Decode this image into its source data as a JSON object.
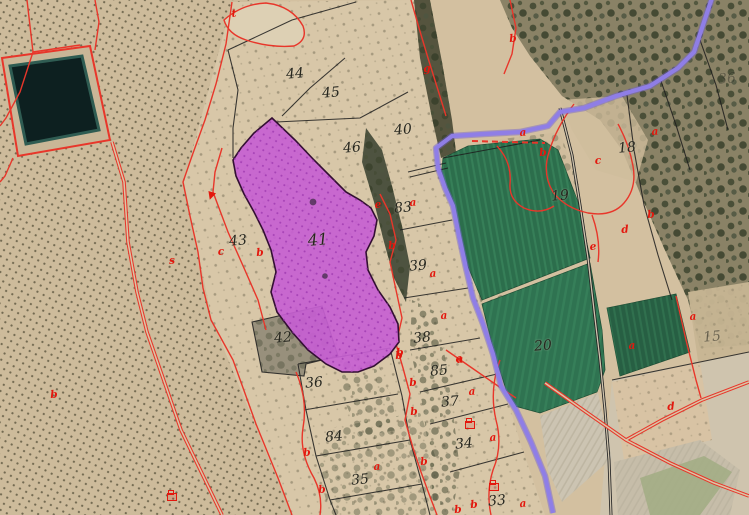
{
  "map": {
    "description": "Cadastral parcel map overlaid on aerial orthophoto; parcel 41 highlighted",
    "colors": {
      "base_tan": "#d3c0a0",
      "light_tan": "#dccdb0",
      "scrub_dark": "#3f462f",
      "water_dark": "#0d2020",
      "water_rim": "#2f5c52",
      "field_green": "#2c6e4c",
      "field_green_dark": "#275f43",
      "plow_gray": "#ccc4b2",
      "cadastral_red": "#e8362a",
      "label_red": "#e3170d",
      "label_black": "#26261e",
      "path_purple": "#8f7ee6",
      "parcel_magenta": "#c760d2",
      "parcel_magenta_dot": "#9c36ae",
      "parcel_border": "#330f33",
      "boundary_black": "#1d1d1d"
    },
    "highlighted_parcel": {
      "number": "41",
      "fill": "#c760d2"
    },
    "parcel_labels": [
      {
        "text": "44",
        "x": 295,
        "y": 74
      },
      {
        "text": "45",
        "x": 331,
        "y": 93
      },
      {
        "text": "46",
        "x": 352,
        "y": 148
      },
      {
        "text": "40",
        "x": 403,
        "y": 130
      },
      {
        "text": "83",
        "x": 403,
        "y": 208
      },
      {
        "text": "41",
        "x": 318,
        "y": 240,
        "size": 16
      },
      {
        "text": "43",
        "x": 238,
        "y": 241
      },
      {
        "text": "39",
        "x": 418,
        "y": 266
      },
      {
        "text": "42",
        "x": 283,
        "y": 338
      },
      {
        "text": "38",
        "x": 422,
        "y": 338
      },
      {
        "text": "36",
        "x": 314,
        "y": 383
      },
      {
        "text": "85",
        "x": 439,
        "y": 371
      },
      {
        "text": "37",
        "x": 450,
        "y": 402
      },
      {
        "text": "84",
        "x": 334,
        "y": 437
      },
      {
        "text": "34",
        "x": 464,
        "y": 444
      },
      {
        "text": "35",
        "x": 360,
        "y": 480
      },
      {
        "text": "33",
        "x": 497,
        "y": 501
      },
      {
        "text": "19",
        "x": 560,
        "y": 196
      },
      {
        "text": "18",
        "x": 627,
        "y": 148
      },
      {
        "text": "20",
        "x": 543,
        "y": 346
      },
      {
        "text": "15",
        "x": 712,
        "y": 337,
        "opacity": 0.55
      },
      {
        "text": "36",
        "x": 727,
        "y": 79,
        "opacity": 0.4
      }
    ],
    "subparcel_labels": [
      {
        "text": "t",
        "x": 234,
        "y": 14
      },
      {
        "text": "g",
        "x": 427,
        "y": 69
      },
      {
        "text": "b",
        "x": 513,
        "y": 39
      },
      {
        "text": "a",
        "x": 523,
        "y": 133
      },
      {
        "text": "b",
        "x": 543,
        "y": 153
      },
      {
        "text": "a",
        "x": 655,
        "y": 132
      },
      {
        "text": "c",
        "x": 598,
        "y": 161
      },
      {
        "text": "b",
        "x": 651,
        "y": 215
      },
      {
        "text": "d",
        "x": 625,
        "y": 230
      },
      {
        "text": "e",
        "x": 593,
        "y": 247
      },
      {
        "text": "e",
        "x": 378,
        "y": 205
      },
      {
        "text": "a",
        "x": 413,
        "y": 203
      },
      {
        "text": "b",
        "x": 392,
        "y": 246
      },
      {
        "text": "a",
        "x": 433,
        "y": 274
      },
      {
        "text": "a",
        "x": 444,
        "y": 316
      },
      {
        "text": "b",
        "x": 400,
        "y": 353
      },
      {
        "text": "a",
        "x": 459,
        "y": 359
      },
      {
        "text": "c",
        "x": 221,
        "y": 252
      },
      {
        "text": "b",
        "x": 260,
        "y": 253
      },
      {
        "text": "s",
        "x": 172,
        "y": 261
      },
      {
        "text": "b",
        "x": 54,
        "y": 395
      },
      {
        "text": "b",
        "x": 399,
        "y": 356
      },
      {
        "text": "a",
        "x": 460,
        "y": 360
      },
      {
        "text": "b",
        "x": 413,
        "y": 383
      },
      {
        "text": "a",
        "x": 472,
        "y": 392
      },
      {
        "text": "b",
        "x": 414,
        "y": 412
      },
      {
        "text": "a",
        "x": 493,
        "y": 438
      },
      {
        "text": "b",
        "x": 307,
        "y": 453
      },
      {
        "text": "a",
        "x": 377,
        "y": 467
      },
      {
        "text": "b",
        "x": 322,
        "y": 490
      },
      {
        "text": "b",
        "x": 424,
        "y": 462
      },
      {
        "text": "a",
        "x": 523,
        "y": 504
      },
      {
        "text": "b",
        "x": 458,
        "y": 510
      },
      {
        "text": "b",
        "x": 474,
        "y": 505
      },
      {
        "text": "a",
        "x": 632,
        "y": 346
      },
      {
        "text": "a",
        "x": 693,
        "y": 317
      },
      {
        "text": "d",
        "x": 671,
        "y": 407
      }
    ],
    "symbols": [
      {
        "type": "well",
        "x": 470,
        "y": 425
      },
      {
        "type": "well",
        "x": 494,
        "y": 487
      },
      {
        "type": "well",
        "x": 172,
        "y": 497
      },
      {
        "type": "arrow",
        "x": 211,
        "y": 196
      }
    ]
  }
}
